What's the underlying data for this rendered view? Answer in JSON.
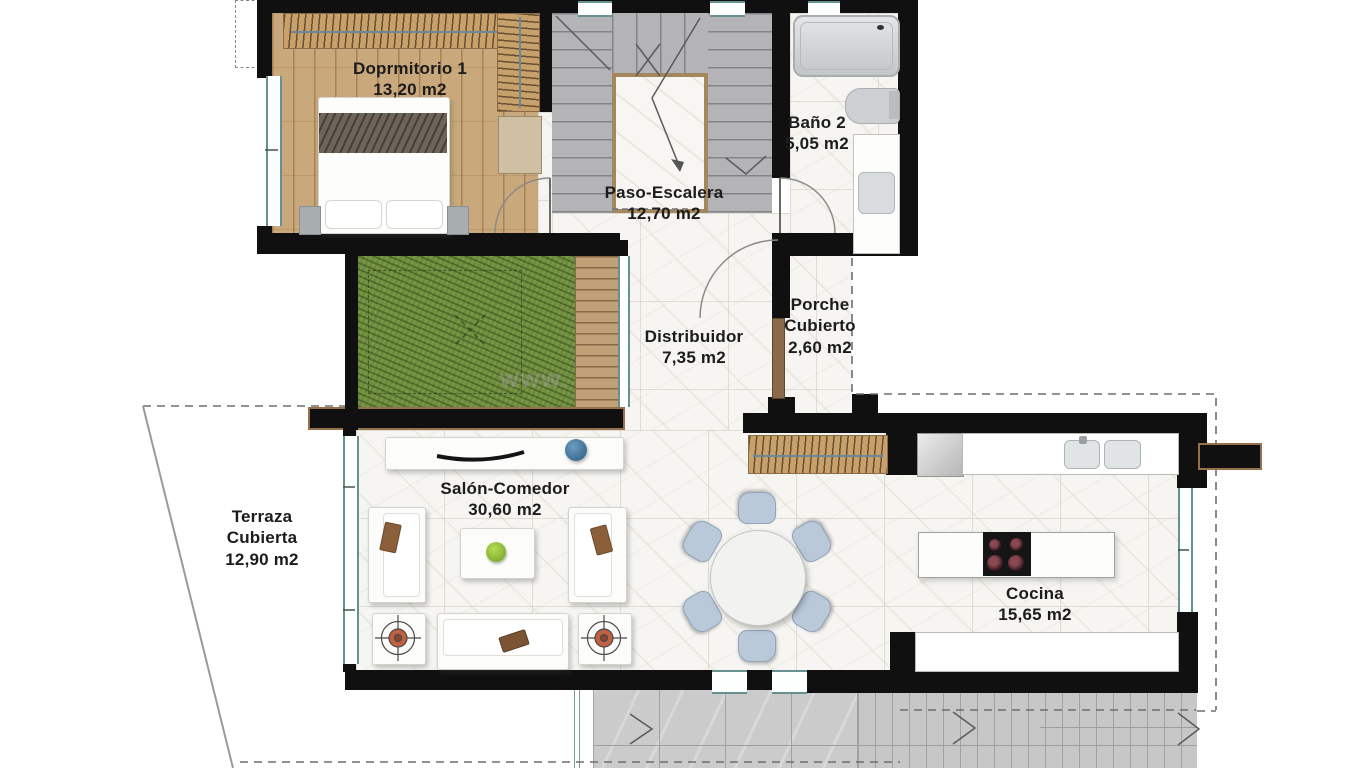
{
  "plan": {
    "watermark": "www.",
    "rooms": [
      {
        "name": "Doprmitorio 1",
        "area": "13,20 m2"
      },
      {
        "name": "Baño 2",
        "area": "5,05 m2"
      },
      {
        "name": "Paso-Escalera",
        "area": "12,70 m2"
      },
      {
        "name": "Distribuidor",
        "area": "7,35 m2"
      },
      {
        "name": "Porche Cubierto",
        "area": "2,60 m2"
      },
      {
        "name": "Terraza Cubierta",
        "area": "12,90 m2"
      },
      {
        "name": "Salón-Comedor",
        "area": "30,60 m2"
      },
      {
        "name": "Cocina",
        "area": "15,65 m2"
      }
    ],
    "colors": {
      "wall": "#101010",
      "wood_floor": "#c9a87c",
      "wardrobe": "#c7a06a",
      "stairs": "#b4b4b7",
      "grass": "#6d8c3e",
      "deck_wood": "#bfa077",
      "deck_gray": "#cbcbcb",
      "glass": "#679090",
      "floor_light": "#f6f5f1",
      "door": "#8a6a4a",
      "chair_blue": "#bac9da",
      "apple_green": "#9acb3c",
      "decor_blue": "#4c7ca3",
      "armchair_accent": "#c06040"
    }
  }
}
